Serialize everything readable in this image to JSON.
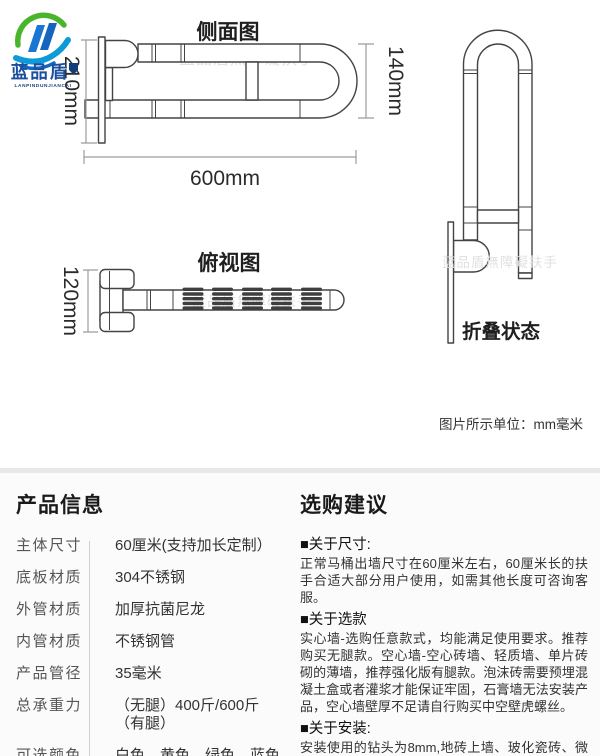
{
  "brand": {
    "name": "蓝品盾",
    "subname": "LANPINDUNJIANCAI",
    "colors": {
      "green": "#4ab42a",
      "blue": "#1565c0",
      "text_blue": "#1b4f9e"
    }
  },
  "diagram": {
    "side_view": {
      "title": "侧面图",
      "dim_height": "210mm",
      "dim_inner": "140mm",
      "dim_length": "600mm",
      "watermark": "蓝品盾無障礙扶手"
    },
    "top_view": {
      "title": "俯视图",
      "dim_width": "120mm",
      "watermark": "蓝品盾無障礙扶手"
    },
    "folded_view": {
      "label": "折叠状态",
      "watermark": "蓝品盾無障礙扶手"
    },
    "units_note": "图片所示单位：mm毫米"
  },
  "product_info": {
    "title": "产品信息",
    "rows": [
      {
        "label": "主体尺寸",
        "value": "60厘米(支持加长定制）"
      },
      {
        "label": "底板材质",
        "value": "304不锈钢"
      },
      {
        "label": "外管材质",
        "value": "加厚抗菌尼龙"
      },
      {
        "label": "内管材质",
        "value": "不锈钢管"
      },
      {
        "label": "产品管径",
        "value": "35毫米"
      },
      {
        "label": "总承重力",
        "value": "（无腿）400斤/600斤（有腿）"
      },
      {
        "label": "可选颜色",
        "value": "白色、黄色、绿色、蓝色"
      }
    ]
  },
  "suggestions": {
    "title": "选购建议",
    "sections": [
      {
        "heading": "■关于尺寸:",
        "body": "正常马桶出墙尺寸在60厘米左右，60厘米长的扶手合适大部分用户使用，如需其他长度可咨询客服。"
      },
      {
        "heading": "■关于选款",
        "body": "实心墙-选购任意款式，均能满足使用要求。推荐购买无腿款。空心墙-空心砖墙、轻质墙、单片砖砌的薄墙，推荐强化版有腿款。泡沫砖需要预埋混凝土盒或者灌浆才能保证牢固，石膏墙无法安装产品，空心墙壁厚不足请自行购买中空壁虎螺丝。"
      },
      {
        "heading": "■关于安装:",
        "body": "安装使用的钻头为8mm,地砖上墙、玻化瓷砖、微晶砖、全瓷砖请使用玻璃钻头打穿后再用冲击钻打内墙。"
      }
    ]
  }
}
